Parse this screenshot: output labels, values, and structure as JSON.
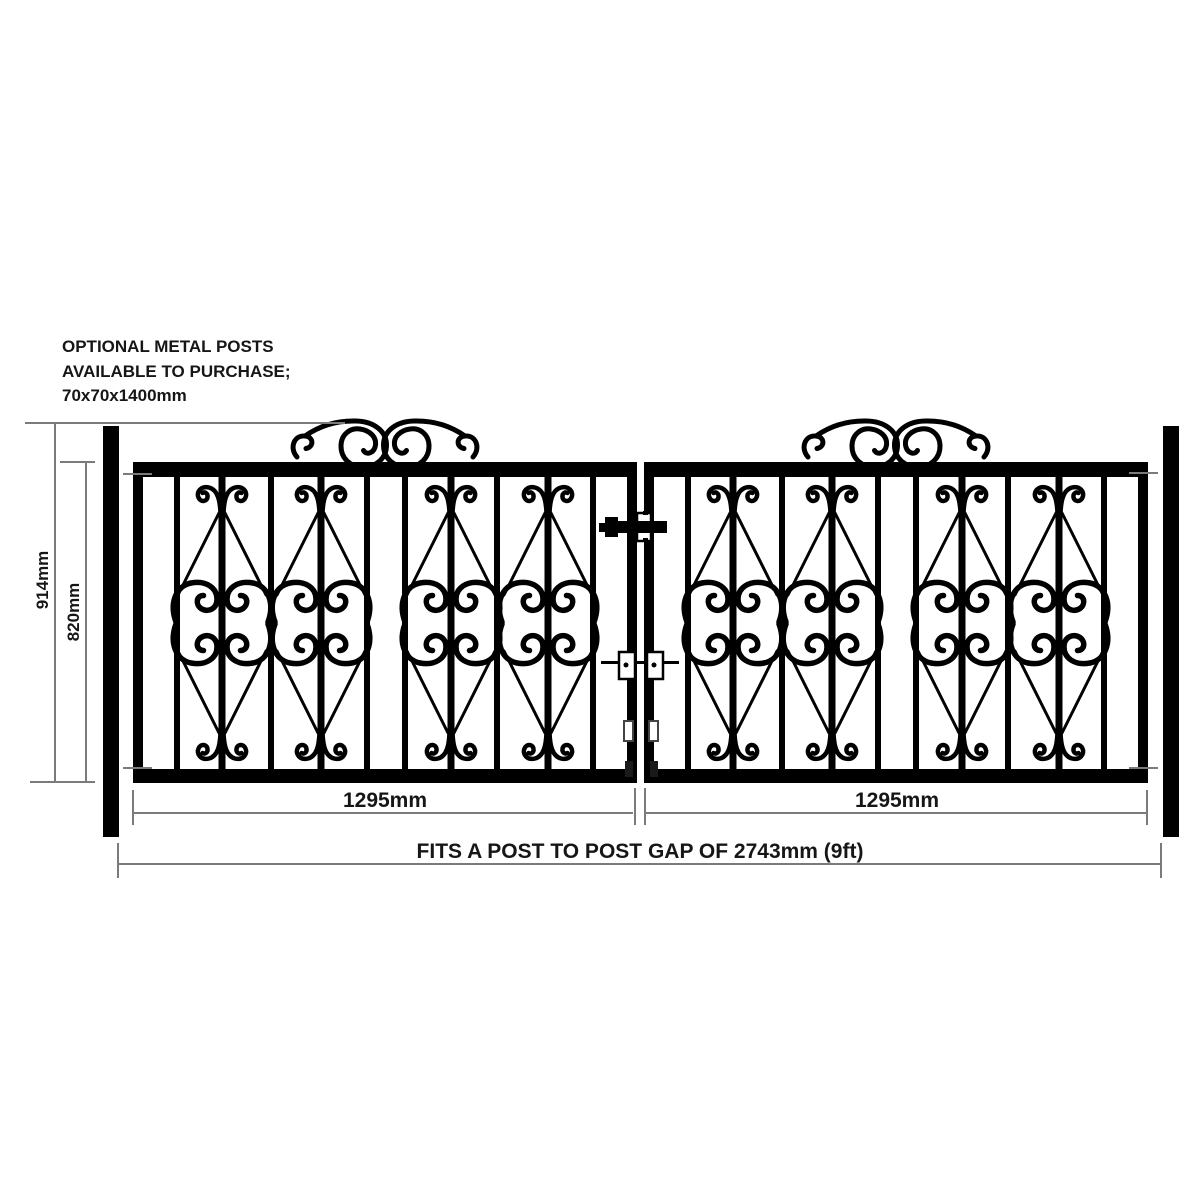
{
  "note": {
    "line1": "OPTIONAL METAL POSTS",
    "line2": "AVAILABLE TO PURCHASE;",
    "line3": "70x70x1400mm"
  },
  "dimensions": {
    "overall_height": "914mm",
    "frame_height": "820mm",
    "left_leaf_width": "1295mm",
    "right_leaf_width": "1295mm",
    "post_gap_note": "FITS A POST TO POST GAP OF 2743mm (9ft)"
  },
  "colors": {
    "metal": "#000000",
    "ink": "#161616",
    "dimension_line": "#7b7b7b",
    "background": "#ffffff"
  }
}
